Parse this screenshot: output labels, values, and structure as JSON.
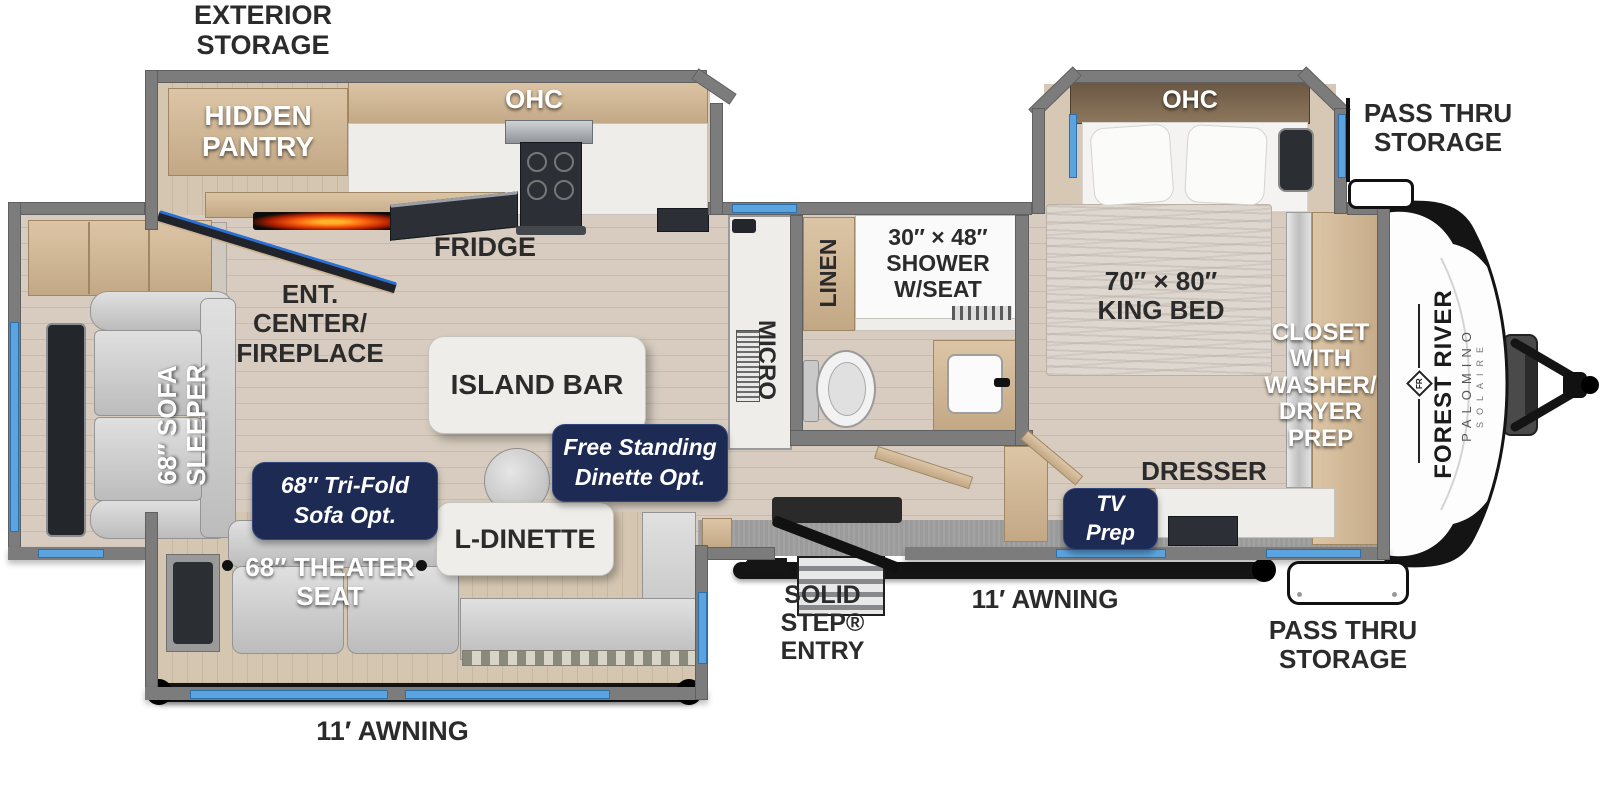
{
  "title": "Travel Trailer Floor Plan",
  "colors": {
    "badge_navy": "#1c2a54",
    "window_blue": "#5ca4df",
    "wall_gray": "#7c7c7c",
    "awning_black": "#141414",
    "fireplace_orange": "#ff7a1a"
  },
  "labels": {
    "exterior_storage": "EXTERIOR\nSTORAGE",
    "hidden_pantry": "HIDDEN\nPANTRY",
    "kitchen_ohc": "OHC",
    "fridge": "FRIDGE",
    "ent_center": "ENT.\nCENTER/\nFIREPLACE",
    "island_bar": "ISLAND BAR",
    "sofa_sleeper": "68″ SOFA\nSLEEPER",
    "theater_seat": "68″ THEATER\nSEAT",
    "l_dinette": "L-DINETTE",
    "micro": "MICRO",
    "linen": "LINEN",
    "shower": "30″ × 48″\nSHOWER\nW/SEAT",
    "king_bed": "70″ × 80″\nKING BED",
    "bedroom_ohc": "OHC",
    "closet": "CLOSET\nWITH\nWASHER/\nDRYER\nPREP",
    "dresser": "DRESSER",
    "pass_thru_top": "PASS THRU\nSTORAGE",
    "pass_thru_bottom": "PASS THRU\nSTORAGE",
    "solid_step_entry": "SOLID STEP®\nENTRY",
    "awning_door_side": "11′ AWNING",
    "awning_off_door_side": "11′ AWNING"
  },
  "option_badges": {
    "tri_fold_sofa": "68″ Tri-Fold\nSofa Opt.",
    "free_standing_dinette": "Free Standing\nDinette Opt.",
    "tv_prep": "TV\nPrep"
  },
  "logo": {
    "brand": "FOREST RIVER",
    "model": "PALOMINO",
    "series": "SOLAIRE",
    "monogram": "FR"
  }
}
